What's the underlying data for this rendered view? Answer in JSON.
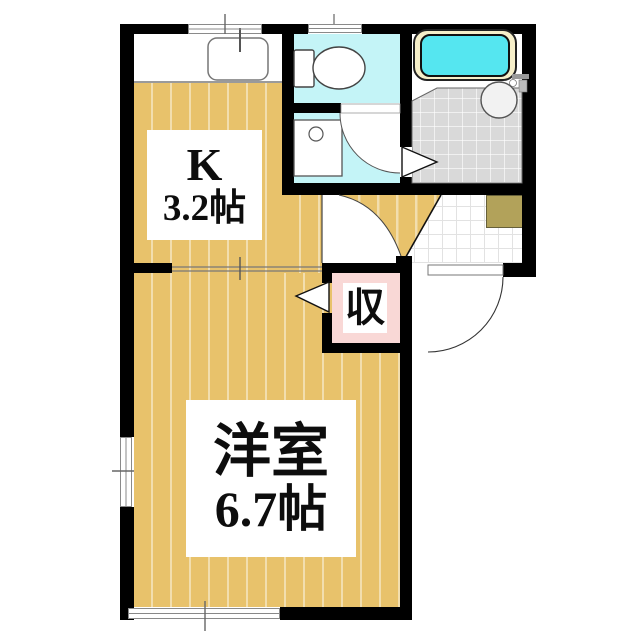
{
  "plan": {
    "type": "apartment-floor-plan",
    "rooms": {
      "kitchen": {
        "abbr": "K",
        "size": "3.2帖"
      },
      "main_room": {
        "name": "洋室",
        "size": "6.7帖"
      },
      "closet": {
        "label": "収"
      },
      "toilet": {
        "label": ""
      },
      "washroom": {
        "label": ""
      },
      "bathroom": {
        "label": ""
      },
      "entrance": {
        "label": ""
      }
    },
    "fixtures": [
      "kitchen-sink",
      "faucet",
      "toilet-bowl",
      "toilet-tank",
      "washbasin",
      "bathtub",
      "bath-basin",
      "doormat",
      "entrance-door",
      "sliding-door",
      "folding-door-closet",
      "folding-door-bath",
      "swing-door-hall",
      "swing-door-washroom",
      "window-kitchen",
      "window-toilet",
      "window-left",
      "window-bottom"
    ]
  },
  "colors": {
    "wall": "#000000",
    "wood": "#e8c26b",
    "wood_stripe": "rgba(255,255,255,0.45)",
    "water_floor": "#c4f4f7",
    "tub_water": "#55e6f0",
    "tub_rim": "#f6efc9",
    "bath_tile": "#d9d9d9",
    "closet_pink": "#f9d8d6",
    "mat": "#b2a25a",
    "tile_line": "#e2e2e2",
    "outline": "#555555"
  }
}
